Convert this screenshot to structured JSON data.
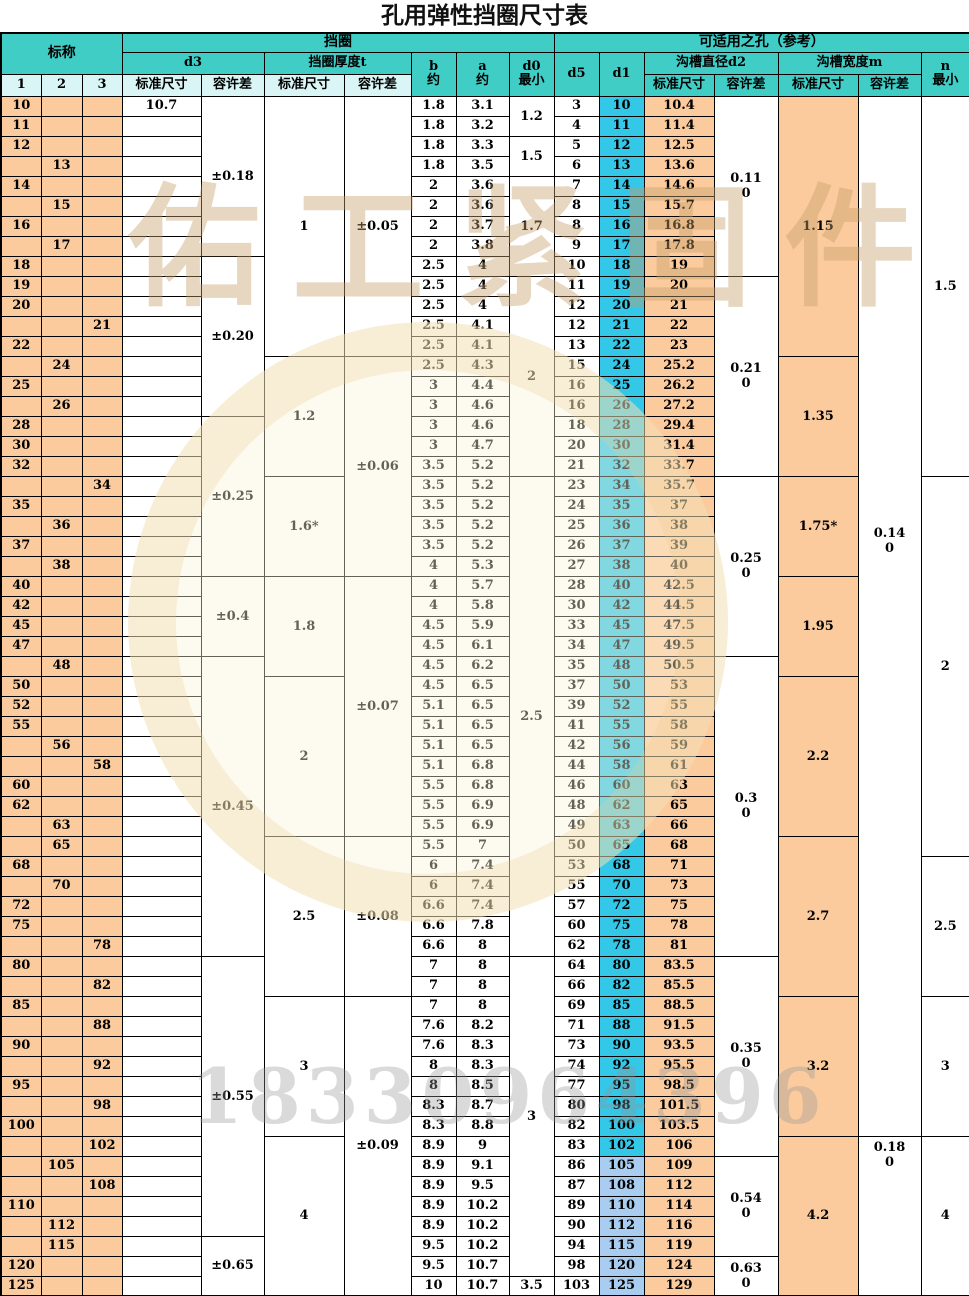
{
  "title": "孔用弹性挡圈尺寸表",
  "header": {
    "nominal": "标称",
    "ring_group": "挡圈",
    "hole_group": "可适用之孔（参考）",
    "d3": "d3",
    "thickness": "挡圈厚度t",
    "b": "b",
    "a": "a",
    "d0": "d0",
    "approx": "约",
    "min": "最小",
    "d5": "d5",
    "d1": "d1",
    "groove_dia": "沟槽直径d2",
    "groove_width": "沟槽宽度m",
    "n": "n",
    "std": "标准尺寸",
    "tol": "容许差",
    "col1": "1",
    "col2": "2",
    "col3": "3"
  },
  "watermarks": {
    "brand": "佑工紧固件",
    "phone": "18330964396"
  },
  "colors": {
    "header_teal": "#3fcdc6",
    "header_light_cyan": "#d9f5f5",
    "cell_peach": "#fbcb9e",
    "d1_cyan": "#33c7e8",
    "d1_light_blue": "#a9cdf0",
    "watermark_tan": "#c69e69",
    "watermark_gray": "#9a9a9a",
    "d1_light_min": 105
  },
  "row_fields": [
    "nominal",
    "preference_column",
    "d3_standard",
    "b_approx",
    "a_approx",
    "d5",
    "d1",
    "d2_standard"
  ],
  "rows": [
    [
      "10",
      "1",
      "10.7",
      "1.8",
      "3.1",
      "3",
      "10",
      "10.4"
    ],
    [
      "11",
      "1",
      "",
      "1.8",
      "3.2",
      "4",
      "11",
      "11.4"
    ],
    [
      "12",
      "1",
      "",
      "1.8",
      "3.3",
      "5",
      "12",
      "12.5"
    ],
    [
      "13",
      "2",
      "",
      "1.8",
      "3.5",
      "6",
      "13",
      "13.6"
    ],
    [
      "14",
      "1",
      "",
      "2",
      "3.6",
      "7",
      "14",
      "14.6"
    ],
    [
      "15",
      "2",
      "",
      "2",
      "3.6",
      "8",
      "15",
      "15.7"
    ],
    [
      "16",
      "1",
      "",
      "2",
      "3.7",
      "8",
      "16",
      "16.8"
    ],
    [
      "17",
      "2",
      "",
      "2",
      "3.8",
      "9",
      "17",
      "17.8"
    ],
    [
      "18",
      "1",
      "",
      "2.5",
      "4",
      "10",
      "18",
      "19"
    ],
    [
      "19",
      "1",
      "",
      "2.5",
      "4",
      "11",
      "19",
      "20"
    ],
    [
      "20",
      "1",
      "",
      "2.5",
      "4",
      "12",
      "20",
      "21"
    ],
    [
      "21",
      "3",
      "",
      "2.5",
      "4.1",
      "12",
      "21",
      "22"
    ],
    [
      "22",
      "1",
      "",
      "2.5",
      "4.1",
      "13",
      "22",
      "23"
    ],
    [
      "24",
      "2",
      "",
      "2.5",
      "4.3",
      "15",
      "24",
      "25.2"
    ],
    [
      "25",
      "1",
      "",
      "3",
      "4.4",
      "16",
      "25",
      "26.2"
    ],
    [
      "26",
      "2",
      "",
      "3",
      "4.6",
      "16",
      "26",
      "27.2"
    ],
    [
      "28",
      "1",
      "",
      "3",
      "4.6",
      "18",
      "28",
      "29.4"
    ],
    [
      "30",
      "1",
      "",
      "3",
      "4.7",
      "20",
      "30",
      "31.4"
    ],
    [
      "32",
      "1",
      "",
      "3.5",
      "5.2",
      "21",
      "32",
      "33.7"
    ],
    [
      "34",
      "3",
      "",
      "3.5",
      "5.2",
      "23",
      "34",
      "35.7"
    ],
    [
      "35",
      "1",
      "",
      "3.5",
      "5.2",
      "24",
      "35",
      "37"
    ],
    [
      "36",
      "2",
      "",
      "3.5",
      "5.2",
      "25",
      "36",
      "38"
    ],
    [
      "37",
      "1",
      "",
      "3.5",
      "5.2",
      "26",
      "37",
      "39"
    ],
    [
      "38",
      "2",
      "",
      "4",
      "5.3",
      "27",
      "38",
      "40"
    ],
    [
      "40",
      "1",
      "",
      "4",
      "5.7",
      "28",
      "40",
      "42.5"
    ],
    [
      "42",
      "1",
      "",
      "4",
      "5.8",
      "30",
      "42",
      "44.5"
    ],
    [
      "45",
      "1",
      "",
      "4.5",
      "5.9",
      "33",
      "45",
      "47.5"
    ],
    [
      "47",
      "1",
      "",
      "4.5",
      "6.1",
      "34",
      "47",
      "49.5"
    ],
    [
      "48",
      "2",
      "",
      "4.5",
      "6.2",
      "35",
      "48",
      "50.5"
    ],
    [
      "50",
      "1",
      "",
      "4.5",
      "6.5",
      "37",
      "50",
      "53"
    ],
    [
      "52",
      "1",
      "",
      "5.1",
      "6.5",
      "39",
      "52",
      "55"
    ],
    [
      "55",
      "1",
      "",
      "5.1",
      "6.5",
      "41",
      "55",
      "58"
    ],
    [
      "56",
      "2",
      "",
      "5.1",
      "6.5",
      "42",
      "56",
      "59"
    ],
    [
      "58",
      "3",
      "",
      "5.1",
      "6.8",
      "44",
      "58",
      "61"
    ],
    [
      "60",
      "1",
      "",
      "5.5",
      "6.8",
      "46",
      "60",
      "63"
    ],
    [
      "62",
      "1",
      "",
      "5.5",
      "6.9",
      "48",
      "62",
      "65"
    ],
    [
      "63",
      "2",
      "",
      "5.5",
      "6.9",
      "49",
      "63",
      "66"
    ],
    [
      "65",
      "2",
      "",
      "5.5",
      "7",
      "50",
      "65",
      "68"
    ],
    [
      "68",
      "1",
      "",
      "6",
      "7.4",
      "53",
      "68",
      "71"
    ],
    [
      "70",
      "2",
      "",
      "6",
      "7.4",
      "55",
      "70",
      "73"
    ],
    [
      "72",
      "1",
      "",
      "6.6",
      "7.4",
      "57",
      "72",
      "75"
    ],
    [
      "75",
      "1",
      "",
      "6.6",
      "7.8",
      "60",
      "75",
      "78"
    ],
    [
      "78",
      "3",
      "",
      "6.6",
      "8",
      "62",
      "78",
      "81"
    ],
    [
      "80",
      "1",
      "",
      "7",
      "8",
      "64",
      "80",
      "83.5"
    ],
    [
      "82",
      "3",
      "",
      "7",
      "8",
      "66",
      "82",
      "85.5"
    ],
    [
      "85",
      "1",
      "",
      "7",
      "8",
      "69",
      "85",
      "88.5"
    ],
    [
      "88",
      "3",
      "",
      "7.6",
      "8.2",
      "71",
      "88",
      "91.5"
    ],
    [
      "90",
      "1",
      "",
      "7.6",
      "8.3",
      "73",
      "90",
      "93.5"
    ],
    [
      "92",
      "3",
      "",
      "8",
      "8.3",
      "74",
      "92",
      "95.5"
    ],
    [
      "95",
      "1",
      "",
      "8",
      "8.5",
      "77",
      "95",
      "98.5"
    ],
    [
      "98",
      "3",
      "",
      "8.3",
      "8.7",
      "80",
      "98",
      "101.5"
    ],
    [
      "100",
      "1",
      "",
      "8.3",
      "8.8",
      "82",
      "100",
      "103.5"
    ],
    [
      "102",
      "3",
      "",
      "8.9",
      "9",
      "83",
      "102",
      "106"
    ],
    [
      "105",
      "2",
      "",
      "8.9",
      "9.1",
      "86",
      "105",
      "109"
    ],
    [
      "108",
      "3",
      "",
      "8.9",
      "9.5",
      "87",
      "108",
      "112"
    ],
    [
      "110",
      "1",
      "",
      "8.9",
      "10.2",
      "89",
      "110",
      "114"
    ],
    [
      "112",
      "2",
      "",
      "8.9",
      "10.2",
      "90",
      "112",
      "116"
    ],
    [
      "115",
      "2",
      "",
      "9.5",
      "10.2",
      "94",
      "115",
      "119"
    ],
    [
      "120",
      "1",
      "",
      "9.5",
      "10.7",
      "98",
      "120",
      "124"
    ],
    [
      "125",
      "1",
      "",
      "10",
      "10.7",
      "103",
      "125",
      "129"
    ]
  ],
  "merges": {
    "d3_tol": [
      [
        "±0.18",
        "10",
        "17"
      ],
      [
        "±0.20",
        "18",
        "26"
      ],
      [
        "±0.25",
        "28",
        "38"
      ],
      [
        "±0.4",
        "40",
        "47"
      ],
      [
        "±0.45",
        "48",
        "78"
      ],
      [
        "±0.55",
        "80",
        "112"
      ],
      [
        "±0.65",
        "115",
        "125"
      ]
    ],
    "t_std": [
      [
        "1",
        "10",
        "22"
      ],
      [
        "1.2",
        "24",
        "32"
      ],
      [
        "1.6*",
        "34",
        "38"
      ],
      [
        "1.8",
        "40",
        "48"
      ],
      [
        "2",
        "50",
        "63"
      ],
      [
        "2.5",
        "65",
        "82"
      ],
      [
        "3",
        "85",
        "100"
      ],
      [
        "4",
        "102",
        "125"
      ]
    ],
    "t_tol": [
      [
        "±0.05",
        "10",
        "22"
      ],
      [
        "±0.06",
        "24",
        "38"
      ],
      [
        "±0.07",
        "40",
        "63"
      ],
      [
        "±0.08",
        "65",
        "82"
      ],
      [
        "±0.09",
        "85",
        "125"
      ]
    ],
    "d0": [
      [
        "1.2",
        "10",
        "11"
      ],
      [
        "1.5",
        "12",
        "13"
      ],
      [
        "1.7",
        "14",
        "18"
      ],
      [
        "2",
        "19",
        "32"
      ],
      [
        "2.5",
        "34",
        "78"
      ],
      [
        "3",
        "80",
        "120"
      ],
      [
        "3.5",
        "125",
        "125"
      ]
    ],
    "d2_tol": [
      [
        [
          "0.11",
          "0"
        ],
        "10",
        "18"
      ],
      [
        [
          "0.21",
          "0"
        ],
        "19",
        "32"
      ],
      [
        [
          "0.25",
          "0"
        ],
        "34",
        "47"
      ],
      [
        [
          "0.3",
          "0"
        ],
        "48",
        "78"
      ],
      [
        [
          "0.35",
          "0"
        ],
        "80",
        "102"
      ],
      [
        [
          "0.54",
          "0"
        ],
        "105",
        "115"
      ],
      [
        [
          "0.63",
          "0"
        ],
        "120",
        "125"
      ]
    ],
    "m_std": [
      [
        "1.15",
        "10",
        "22"
      ],
      [
        "1.35",
        "24",
        "32"
      ],
      [
        "1.75*",
        "34",
        "38"
      ],
      [
        "1.95",
        "40",
        "48"
      ],
      [
        "2.2",
        "50",
        "63"
      ],
      [
        "2.7",
        "65",
        "82"
      ],
      [
        "3.2",
        "85",
        "100"
      ],
      [
        "4.2",
        "102",
        "125"
      ]
    ],
    "m_tol": [
      [
        [
          "0.14",
          "0"
        ],
        "10",
        "100",
        "upper"
      ],
      [
        [
          "0.18",
          "0"
        ],
        "102",
        "125",
        "top"
      ]
    ],
    "n": [
      [
        "1.5",
        "10",
        "32"
      ],
      [
        "2",
        "34",
        "65"
      ],
      [
        "2.5",
        "68",
        "82"
      ],
      [
        "3",
        "85",
        "100"
      ],
      [
        "4",
        "102",
        "125"
      ]
    ]
  }
}
